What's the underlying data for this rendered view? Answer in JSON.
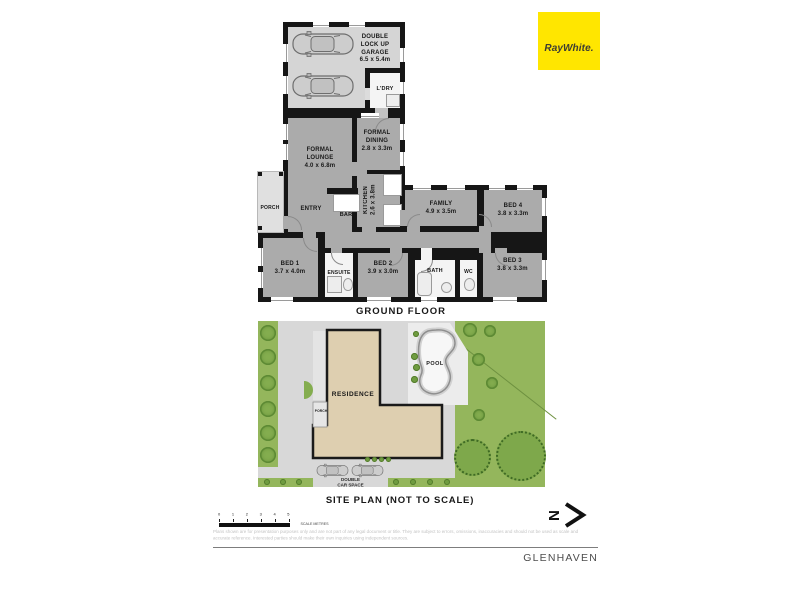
{
  "brand": {
    "logo_text": "RayWhite."
  },
  "floor_plan": {
    "title": "GROUND FLOOR",
    "rooms": {
      "garage": {
        "name": "DOUBLE LOCK UP GARAGE",
        "dims": "6.5 x 5.4m"
      },
      "laundry": {
        "name": "L'DRY"
      },
      "formal_dining": {
        "name": "FORMAL DINING",
        "dims": "2.8 x 3.3m"
      },
      "formal_lounge": {
        "name": "FORMAL LOUNGE",
        "dims": "4.0 x 6.8m"
      },
      "kitchen": {
        "name": "KITCHEN",
        "dims": "2.6 x 3.8m"
      },
      "porch": {
        "name": "PORCH"
      },
      "entry": {
        "name": "ENTRY"
      },
      "bar": {
        "name": "BAR"
      },
      "family": {
        "name": "FAMILY",
        "dims": "4.9 x 3.5m"
      },
      "bed4": {
        "name": "BED 4",
        "dims": "3.8 x 3.3m"
      },
      "bed1": {
        "name": "BED 1",
        "dims": "3.7 x 4.0m"
      },
      "ensuite": {
        "name": "ENSUITE"
      },
      "bed2": {
        "name": "BED 2",
        "dims": "3.9 x 3.0m"
      },
      "bath": {
        "name": "BATH"
      },
      "wc": {
        "name": "WC"
      },
      "bed3": {
        "name": "BED 3",
        "dims": "3.8 x 3.3m"
      }
    }
  },
  "site_plan": {
    "title": "SITE PLAN (NOT TO SCALE)",
    "residence_label": "RESIDENCE",
    "pool_label": "POOL",
    "porch_label": "PORCH",
    "car_space_label_line1": "DOUBLE",
    "car_space_label_line2": "CAR SPACE"
  },
  "scale_bar": {
    "ticks": [
      "0",
      "1",
      "2",
      "3",
      "4",
      "5"
    ],
    "unit_label": "SCALE METRES"
  },
  "compass": {
    "letter": "N"
  },
  "disclaimer": {
    "line1": "Plans shown are for presentation purposes only and are not part of any legal document or title. They are subject to errors, omissions, inaccuracies and should not be used as scale and",
    "line2": "accurate reference. Interested parties should make their own inquiries using independent sources."
  },
  "footer": {
    "suburb": "GLENHAVEN"
  },
  "colors": {
    "brand_yellow": "#FFE600",
    "wall_black": "#161616",
    "room_gray": "#ABABAB",
    "garage_gray": "#D5D5D5",
    "lawn_green": "#94B65C",
    "residence_tan": "#DECFB0",
    "driveway_gray": "#D8D8D8"
  }
}
